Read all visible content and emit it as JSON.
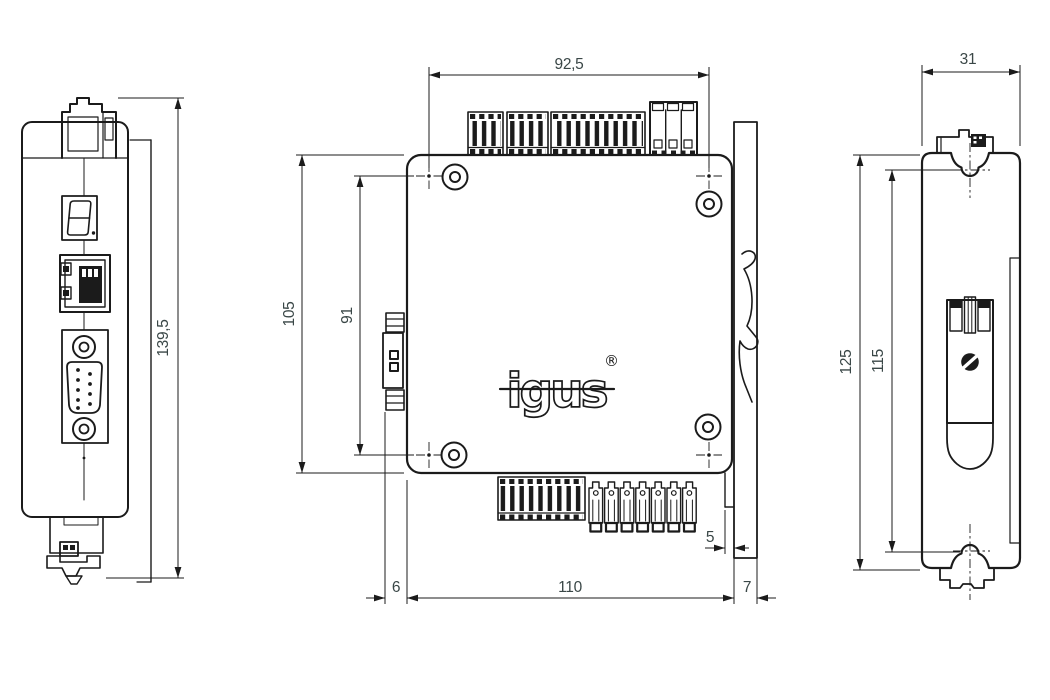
{
  "canvas": {
    "width": 1050,
    "height": 700,
    "background": "#ffffff",
    "line_color": "#1b1b1b",
    "dim_text_color": "#3a4747"
  },
  "logo": {
    "text": "igus",
    "registered": "®"
  },
  "dimensions": {
    "front_height": "139,5",
    "mount_hole_spacing_x": "92,5",
    "body_height": "105",
    "mount_hole_spacing_y": "91",
    "connector_protrusion": "6",
    "body_width": "110",
    "rail_plate_overhang": "7",
    "rail_step": "5",
    "side_depth": "31",
    "side_height": "125",
    "clip_span": "115"
  }
}
